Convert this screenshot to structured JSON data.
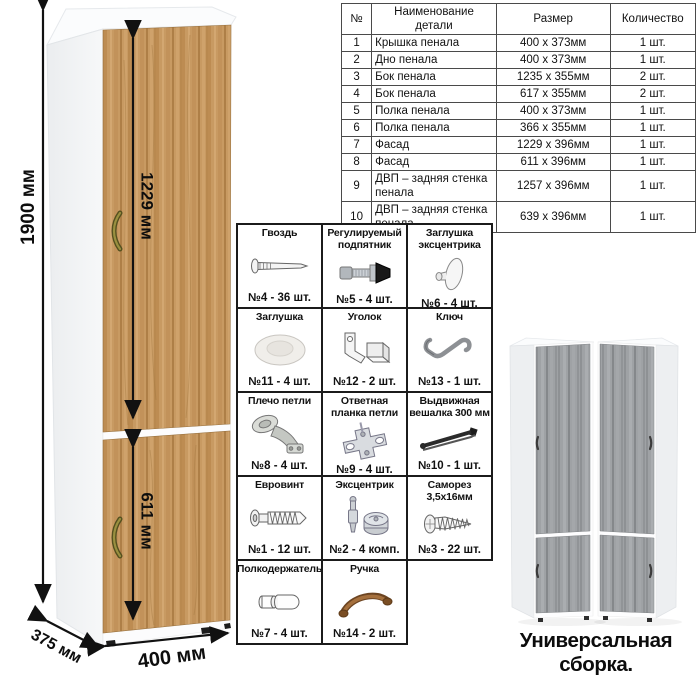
{
  "dimensions": {
    "height": "1900 мм",
    "upper_door": "1229 мм",
    "lower_door": "611 мм",
    "depth": "375 мм",
    "width": "400 мм"
  },
  "parts_table": {
    "headers": [
      "№",
      "Наименование детали",
      "Размер",
      "Количество"
    ],
    "rows": [
      [
        "1",
        "Крышка пенала",
        "400 х 373мм",
        "1 шт."
      ],
      [
        "2",
        "Дно пенала",
        "400 х 373мм",
        "1 шт."
      ],
      [
        "3",
        "Бок пенала",
        "1235 х 355мм",
        "2 шт."
      ],
      [
        "4",
        "Бок пенала",
        "617 х 355мм",
        "2 шт."
      ],
      [
        "5",
        "Полка пенала",
        "400 х 373мм",
        "1 шт."
      ],
      [
        "6",
        "Полка пенала",
        "366 х 355мм",
        "1 шт."
      ],
      [
        "7",
        "Фасад",
        "1229 х 396мм",
        "1 шт."
      ],
      [
        "8",
        "Фасад",
        "611 х 396мм",
        "1 шт."
      ],
      [
        "9",
        "ДВП – задняя стенка пенала",
        "1257 х 396мм",
        "1 шт."
      ],
      [
        "10",
        "ДВП – задняя стенка пенала",
        "639 х 396мм",
        "1 шт."
      ]
    ]
  },
  "hardware": {
    "items": [
      {
        "name": "Гвоздь",
        "count": "№4 - 36 шт.",
        "icon": "nail-icon"
      },
      {
        "name": "Регулируемый подпятник",
        "count": "№5 - 4 шт.",
        "icon": "adjustable-foot-icon"
      },
      {
        "name": "Заглушка эксцентрика",
        "count": "№6 - 4 шт.",
        "icon": "cam-cap-icon"
      },
      {
        "name": "Заглушка",
        "count": "№11 - 4 шт.",
        "icon": "cap-icon"
      },
      {
        "name": "Уголок",
        "count": "№12 - 2 шт.",
        "icon": "corner-bracket-icon"
      },
      {
        "name": "Ключ",
        "count": "№13 - 1 шт.",
        "icon": "hex-key-icon"
      },
      {
        "name": "Плечо петли",
        "count": "№8 - 4 шт.",
        "icon": "hinge-arm-icon"
      },
      {
        "name": "Ответная планка петли",
        "count": "№9 - 4 шт.",
        "icon": "hinge-plate-icon"
      },
      {
        "name": "Выдвижная вешалка 300 мм",
        "count": "№10 - 1 шт.",
        "icon": "pullout-hanger-icon"
      },
      {
        "name": "Евровинт",
        "count": "№1 - 12 шт.",
        "icon": "euro-screw-icon"
      },
      {
        "name": "Эксцентрик",
        "count": "№2 - 4 комп.",
        "icon": "cam-lock-icon"
      },
      {
        "name": "Саморез 3,5х16мм",
        "count": "№3 - 22 шт.",
        "icon": "screw-icon"
      },
      {
        "name": "Полкодержатель",
        "count": "№7 - 4 шт.",
        "icon": "shelf-pin-icon"
      },
      {
        "name": "Ручка",
        "count": "№14 - 2 шт.",
        "icon": "handle-icon"
      }
    ],
    "columns": 3
  },
  "footer": {
    "caption": "Универсальная сборка."
  },
  "colors": {
    "wood": "#c89a62",
    "wood_dark": "#ae7f47",
    "gray_wood": "#9fa2a5",
    "carcass_white": "#fdfdfd",
    "line_black": "#111111",
    "handle_bronze": "#8c8440"
  }
}
